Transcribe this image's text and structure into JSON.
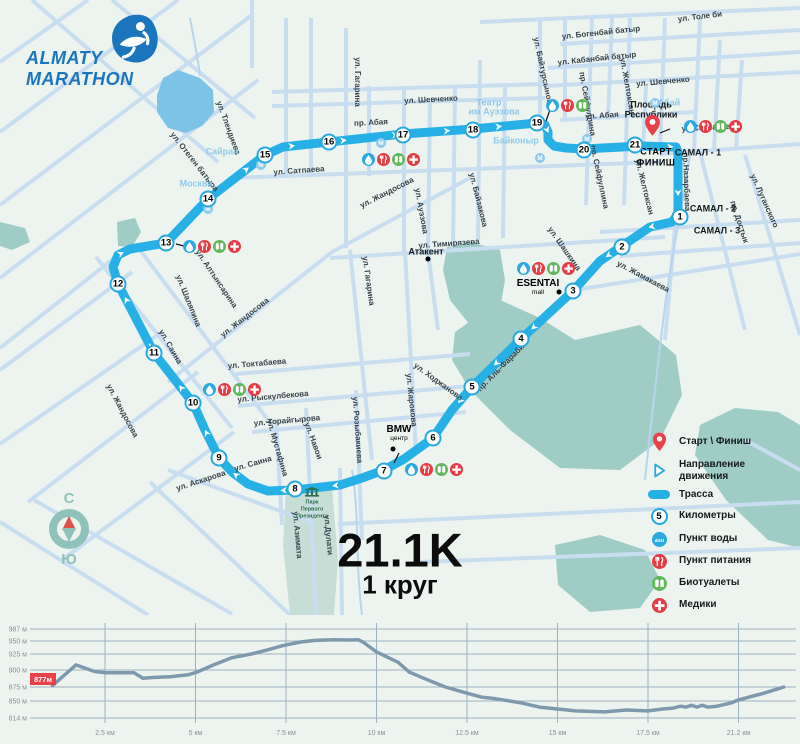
{
  "logo": {
    "line1": "ALMATY",
    "line2": "MARATHON"
  },
  "distance": {
    "title": "21.1K",
    "subtitle": "1 круг"
  },
  "compass": {
    "north": "С",
    "south": "Ю"
  },
  "start_finish": {
    "line1": "СТАРТ",
    "line2": "ФИНИШ"
  },
  "colors": {
    "route": "#27b0e6",
    "street": "#c9ddf1",
    "water_body": "#7cc3e8",
    "park": "#9fcdc5",
    "park_light": "#c6ded5",
    "bg": "#edf4ef",
    "water_icon": "#2aa9e1",
    "food_icon": "#e63a44",
    "toilet_icon": "#62b75c",
    "medic_icon": "#e63a44",
    "metro": "#8ec9ea",
    "pin": "#e8414a",
    "elev_line": "#7e99ad",
    "elev_grid": "#9db1c2",
    "elev_text": "#868f98",
    "badge": "#e8414a"
  },
  "legend": {
    "items": [
      {
        "icon": "pin",
        "label": "Старт \\ Финиш"
      },
      {
        "icon": "arrow",
        "label": "Направление движения"
      },
      {
        "icon": "route",
        "label": "Трасса"
      },
      {
        "icon": "kmcircle",
        "label": "Километры",
        "sample": "5"
      },
      {
        "icon": "water",
        "label": "Пункт воды"
      },
      {
        "icon": "food",
        "label": "Пункт питания"
      },
      {
        "icon": "toilet",
        "label": "Биотуалеты"
      },
      {
        "icon": "medic",
        "label": "Медики"
      }
    ]
  },
  "map": {
    "route": {
      "points": [
        [
          640,
          146
        ],
        [
          676,
          147
        ],
        [
          678,
          152
        ],
        [
          678,
          214
        ],
        [
          672,
          222
        ],
        [
          650,
          227
        ],
        [
          600,
          261
        ],
        [
          573,
          291
        ],
        [
          521,
          339
        ],
        [
          472,
          387
        ],
        [
          452,
          410
        ],
        [
          433,
          438
        ],
        [
          404,
          459
        ],
        [
          384,
          470
        ],
        [
          362,
          478
        ],
        [
          340,
          485
        ],
        [
          295,
          490
        ],
        [
          268,
          491
        ],
        [
          248,
          484
        ],
        [
          232,
          472
        ],
        [
          219,
          458
        ],
        [
          205,
          430
        ],
        [
          193,
          403
        ],
        [
          154,
          353
        ],
        [
          118,
          284
        ],
        [
          113,
          267
        ],
        [
          118,
          255
        ],
        [
          130,
          249
        ],
        [
          166,
          243
        ],
        [
          208,
          199
        ],
        [
          265,
          155
        ],
        [
          283,
          147
        ],
        [
          310,
          144
        ],
        [
          329,
          142
        ],
        [
          403,
          134
        ],
        [
          473,
          129
        ],
        [
          537,
          123
        ],
        [
          545,
          125
        ],
        [
          548,
          132
        ],
        [
          548,
          140
        ],
        [
          554,
          146
        ],
        [
          566,
          148
        ],
        [
          584,
          149
        ],
        [
          640,
          146
        ]
      ]
    },
    "km_markers": [
      {
        "n": "1",
        "x": 680,
        "y": 217
      },
      {
        "n": "2",
        "x": 622,
        "y": 247
      },
      {
        "n": "3",
        "x": 573,
        "y": 291
      },
      {
        "n": "4",
        "x": 521,
        "y": 339
      },
      {
        "n": "5",
        "x": 472,
        "y": 387
      },
      {
        "n": "6",
        "x": 433,
        "y": 438
      },
      {
        "n": "7",
        "x": 384,
        "y": 471
      },
      {
        "n": "8",
        "x": 295,
        "y": 489
      },
      {
        "n": "9",
        "x": 219,
        "y": 458
      },
      {
        "n": "10",
        "x": 193,
        "y": 403
      },
      {
        "n": "11",
        "x": 154,
        "y": 353
      },
      {
        "n": "12",
        "x": 118,
        "y": 284
      },
      {
        "n": "13",
        "x": 166,
        "y": 243
      },
      {
        "n": "14",
        "x": 208,
        "y": 199
      },
      {
        "n": "15",
        "x": 265,
        "y": 155
      },
      {
        "n": "16",
        "x": 329,
        "y": 142
      },
      {
        "n": "17",
        "x": 403,
        "y": 135
      },
      {
        "n": "18",
        "x": 473,
        "y": 130
      },
      {
        "n": "19",
        "x": 537,
        "y": 123
      },
      {
        "n": "20",
        "x": 584,
        "y": 150
      },
      {
        "n": "21",
        "x": 635,
        "y": 145
      }
    ],
    "aid_stations": [
      {
        "x": 183,
        "y": 240,
        "icons": [
          "water",
          "food",
          "toilet",
          "medic"
        ]
      },
      {
        "x": 203,
        "y": 383,
        "icons": [
          "water",
          "food",
          "toilet",
          "medic"
        ]
      },
      {
        "x": 405,
        "y": 463,
        "icons": [
          "water",
          "food",
          "toilet",
          "medic"
        ]
      },
      {
        "x": 517,
        "y": 262,
        "icons": [
          "water",
          "food",
          "toilet",
          "medic"
        ]
      },
      {
        "x": 362,
        "y": 153,
        "icons": [
          "water",
          "food",
          "toilet",
          "medic"
        ]
      },
      {
        "x": 546,
        "y": 99,
        "icons": [
          "water",
          "food",
          "toilet"
        ]
      },
      {
        "x": 684,
        "y": 120,
        "icons": [
          "water",
          "food",
          "toilet",
          "medic"
        ]
      }
    ],
    "metro_icons": [
      [
        208,
        209
      ],
      [
        261,
        165
      ],
      [
        381,
        143
      ],
      [
        540,
        158
      ],
      [
        655,
        103
      ],
      [
        587,
        139
      ]
    ],
    "dots": [
      [
        428,
        259
      ],
      [
        559,
        292
      ],
      [
        393,
        449
      ]
    ],
    "labels": [
      {
        "t": "ул. Толе би",
        "x": 700,
        "y": 17,
        "r": -7,
        "c": "st"
      },
      {
        "t": "ул. Богенбай батыр",
        "x": 601,
        "y": 33,
        "r": -6,
        "c": "st"
      },
      {
        "t": "ул. Кабанбай батыр",
        "x": 597,
        "y": 59,
        "r": -6,
        "c": "st"
      },
      {
        "t": "ул. Шевченко",
        "x": 663,
        "y": 82,
        "r": -5,
        "c": "st"
      },
      {
        "t": "ул. Шевченко",
        "x": 431,
        "y": 100,
        "r": -3,
        "c": "st"
      },
      {
        "t": "пр. Абая",
        "x": 371,
        "y": 123,
        "r": -3,
        "c": "st"
      },
      {
        "t": "ул. Абая",
        "x": 602,
        "y": 116,
        "r": -4,
        "c": "st"
      },
      {
        "t": "ул. Сатпаева",
        "x": 299,
        "y": 171,
        "r": -4,
        "c": "st"
      },
      {
        "t": "ул.Сатпаева",
        "x": 706,
        "y": 128,
        "r": -3,
        "c": "st"
      },
      {
        "t": "ул. Тимирязева",
        "x": 449,
        "y": 244,
        "r": -4,
        "c": "st"
      },
      {
        "t": "ул. Токтабаева",
        "x": 257,
        "y": 364,
        "r": -5,
        "c": "st"
      },
      {
        "t": "ул. Рыскулбекова",
        "x": 273,
        "y": 397,
        "r": -5,
        "c": "st"
      },
      {
        "t": "ул. Торайгырова",
        "x": 287,
        "y": 421,
        "r": -5,
        "c": "st"
      },
      {
        "t": "ул. Саина",
        "x": 253,
        "y": 464,
        "r": -16,
        "c": "st"
      },
      {
        "t": "ул. Саина",
        "x": 170,
        "y": 347,
        "r": 60,
        "c": "st"
      },
      {
        "t": "ул. Аскарова",
        "x": 201,
        "y": 481,
        "r": -18,
        "c": "st"
      },
      {
        "t": "ул. Мустафина",
        "x": 277,
        "y": 448,
        "r": 74,
        "c": "st"
      },
      {
        "t": "ул. Навои",
        "x": 313,
        "y": 441,
        "r": 70,
        "c": "st"
      },
      {
        "t": "ул. Розыбакиева",
        "x": 357,
        "y": 430,
        "r": 86,
        "c": "st"
      },
      {
        "t": "ул. Жарокова",
        "x": 411,
        "y": 400,
        "r": 84,
        "c": "st"
      },
      {
        "t": "ул. Гагарина",
        "x": 368,
        "y": 281,
        "r": 82,
        "c": "st"
      },
      {
        "t": "ул. Гагарина",
        "x": 357,
        "y": 82,
        "r": 90,
        "c": "st"
      },
      {
        "t": "ул. Жандосова",
        "x": 387,
        "y": 193,
        "r": -27,
        "c": "st"
      },
      {
        "t": "ул. Жандосова",
        "x": 245,
        "y": 318,
        "r": -38,
        "c": "st"
      },
      {
        "t": "ул. Жандосова",
        "x": 122,
        "y": 411,
        "r": 62,
        "c": "st"
      },
      {
        "t": "ул. Алтынсарина",
        "x": 216,
        "y": 279,
        "r": 56,
        "c": "st"
      },
      {
        "t": "ул. Шаляпина",
        "x": 188,
        "y": 301,
        "r": 68,
        "c": "st"
      },
      {
        "t": "ул. Отеген батыра",
        "x": 194,
        "y": 162,
        "r": 52,
        "c": "st"
      },
      {
        "t": "ул. Тлендиева",
        "x": 228,
        "y": 128,
        "r": 70,
        "c": "st"
      },
      {
        "t": "ул. Ауэзова",
        "x": 421,
        "y": 211,
        "r": 80,
        "c": "st"
      },
      {
        "t": "ул. Байзакова",
        "x": 478,
        "y": 200,
        "r": 76,
        "c": "st"
      },
      {
        "t": "ул. Шашкина",
        "x": 564,
        "y": 249,
        "r": 55,
        "c": "st"
      },
      {
        "t": "ул. Ходжанова",
        "x": 438,
        "y": 382,
        "r": 36,
        "c": "st"
      },
      {
        "t": "пр. Аль-Фараби",
        "x": 501,
        "y": 368,
        "r": -45,
        "c": "st"
      },
      {
        "t": "ул. Жамакаева",
        "x": 643,
        "y": 277,
        "r": 28,
        "c": "st"
      },
      {
        "t": "пр. Достык",
        "x": 739,
        "y": 222,
        "r": 72,
        "c": "st"
      },
      {
        "t": "ул. Луганского",
        "x": 764,
        "y": 201,
        "r": 66,
        "c": "st"
      },
      {
        "t": "пр.Назарбаева",
        "x": 686,
        "y": 182,
        "r": 88,
        "c": "st"
      },
      {
        "t": "ул. Желтоксан",
        "x": 627,
        "y": 86,
        "r": 80,
        "c": "st"
      },
      {
        "t": "пр. Сейфуллина",
        "x": 587,
        "y": 104,
        "r": 80,
        "c": "st"
      },
      {
        "t": "ул. Байтурсынова",
        "x": 543,
        "y": 73,
        "r": 78,
        "c": "st"
      },
      {
        "t": "пр. Сейфуллина",
        "x": 599,
        "y": 177,
        "r": 78,
        "c": "st"
      },
      {
        "t": "ул. Желтоксан",
        "x": 644,
        "y": 187,
        "r": 76,
        "c": "st"
      },
      {
        "t": "ул.Дулати",
        "x": 328,
        "y": 535,
        "r": 85,
        "c": "st"
      },
      {
        "t": "ул. Азимата",
        "x": 297,
        "y": 535,
        "r": 85,
        "c": "st"
      },
      {
        "t": "Сайран",
        "x": 222,
        "y": 152,
        "r": 0,
        "c": "mt"
      },
      {
        "t": "Москва",
        "x": 196,
        "y": 184,
        "r": 0,
        "c": "mt"
      },
      {
        "t": "Байконыр",
        "x": 516,
        "y": 141,
        "r": 0,
        "c": "mt"
      },
      {
        "t": "Абай",
        "x": 669,
        "y": 103,
        "r": 0,
        "c": "mt"
      },
      {
        "t": "Театр",
        "x": 489,
        "y": 103,
        "r": 0,
        "c": "mt"
      },
      {
        "t": "им Ауэзова",
        "x": 494,
        "y": 112,
        "r": 0,
        "c": "mt"
      },
      {
        "t": "САМАЛ - 1",
        "x": 698,
        "y": 153,
        "r": 0,
        "c": "di"
      },
      {
        "t": "САМАЛ - 2",
        "x": 713,
        "y": 209,
        "r": 0,
        "c": "di"
      },
      {
        "t": "САМАЛ - 3",
        "x": 717,
        "y": 231,
        "r": 0,
        "c": "di"
      },
      {
        "t": "Площадь",
        "x": 651,
        "y": 105,
        "r": 0,
        "c": "di"
      },
      {
        "t": "Республики",
        "x": 651,
        "y": 115,
        "r": 0,
        "c": "di"
      },
      {
        "t": "Атакент",
        "x": 426,
        "y": 252,
        "r": 0,
        "c": "di"
      },
      {
        "t": "ESENTAI",
        "x": 538,
        "y": 284,
        "r": 0,
        "c": "poi-bold"
      },
      {
        "t": "mall",
        "x": 538,
        "y": 293,
        "r": 0,
        "c": "poi-small"
      },
      {
        "t": "BMW",
        "x": 399,
        "y": 430,
        "r": 0,
        "c": "poi-bold"
      },
      {
        "t": "центр",
        "x": 399,
        "y": 439,
        "r": 0,
        "c": "poi-small"
      },
      {
        "t": "СТАРТ",
        "x": 656,
        "y": 152,
        "r": 0,
        "c": "sf"
      },
      {
        "t": "ФИНИШ",
        "x": 656,
        "y": 163,
        "r": 0,
        "c": "sf"
      },
      {
        "t": "Парк",
        "x": 312,
        "y": 503,
        "r": 0,
        "c": "pk"
      },
      {
        "t": "Первого",
        "x": 312,
        "y": 510,
        "r": 0,
        "c": "pk"
      },
      {
        "t": "Президента",
        "x": 312,
        "y": 517,
        "r": 0,
        "c": "pk"
      }
    ]
  },
  "chart_data": {
    "type": "line",
    "title": "",
    "xlabel": "",
    "ylabel": "",
    "start_badge": "877м",
    "y_ticks": [
      {
        "label": "987 м",
        "value": 987,
        "y": 629
      },
      {
        "label": "950 м",
        "value": 950,
        "y": 641
      },
      {
        "label": "925 м",
        "value": 925,
        "y": 654
      },
      {
        "label": "900 м",
        "value": 900,
        "y": 670
      },
      {
        "label": "875 м",
        "value": 875,
        "y": 687
      },
      {
        "label": "850 м",
        "value": 850,
        "y": 701
      },
      {
        "label": "814 м",
        "value": 814,
        "y": 718
      }
    ],
    "x_ticks": [
      {
        "label": "2.5 км",
        "km": 2.5
      },
      {
        "label": "5 км",
        "km": 5
      },
      {
        "label": "7.5 км",
        "km": 7.5
      },
      {
        "label": "10 км",
        "km": 10
      },
      {
        "label": "12.5 км",
        "km": 12.5
      },
      {
        "label": "15 км",
        "km": 15
      },
      {
        "label": "17.5 км",
        "km": 17.5
      },
      {
        "label": "21.2 км",
        "km": 20
      }
    ],
    "x0_px": 14.5,
    "px_per_km": 36.2,
    "points": [
      [
        1.05,
        877
      ],
      [
        1.7,
        908
      ],
      [
        2.2,
        898
      ],
      [
        2.5,
        896
      ],
      [
        3.3,
        896
      ],
      [
        3.55,
        888
      ],
      [
        3.8,
        889
      ],
      [
        4.3,
        890
      ],
      [
        4.8,
        893
      ],
      [
        5.05,
        897
      ],
      [
        5.5,
        908
      ],
      [
        6.0,
        919
      ],
      [
        6.6,
        926
      ],
      [
        7.0,
        933
      ],
      [
        7.4,
        941
      ],
      [
        7.9,
        948
      ],
      [
        8.3,
        952
      ],
      [
        8.8,
        954
      ],
      [
        9.3,
        953
      ],
      [
        9.5,
        954
      ],
      [
        9.65,
        947
      ],
      [
        10.0,
        929
      ],
      [
        10.3,
        920
      ],
      [
        10.6,
        912
      ],
      [
        10.9,
        897
      ],
      [
        11.3,
        888
      ],
      [
        11.9,
        875
      ],
      [
        12.5,
        864
      ],
      [
        12.9,
        857
      ],
      [
        13.3,
        854
      ],
      [
        14.0,
        846
      ],
      [
        14.5,
        837
      ],
      [
        15.0,
        833
      ],
      [
        15.5,
        829
      ],
      [
        16.3,
        827
      ],
      [
        16.9,
        831
      ],
      [
        17.5,
        829
      ],
      [
        17.9,
        833
      ],
      [
        18.2,
        835
      ],
      [
        18.4,
        839
      ],
      [
        18.55,
        837
      ],
      [
        18.7,
        841
      ],
      [
        18.85,
        837
      ],
      [
        19.0,
        841
      ],
      [
        19.15,
        837
      ],
      [
        19.4,
        839
      ],
      [
        19.8,
        846
      ],
      [
        20.0,
        852
      ],
      [
        20.4,
        859
      ],
      [
        20.7,
        864
      ],
      [
        21.0,
        870
      ],
      [
        21.25,
        875
      ]
    ]
  }
}
